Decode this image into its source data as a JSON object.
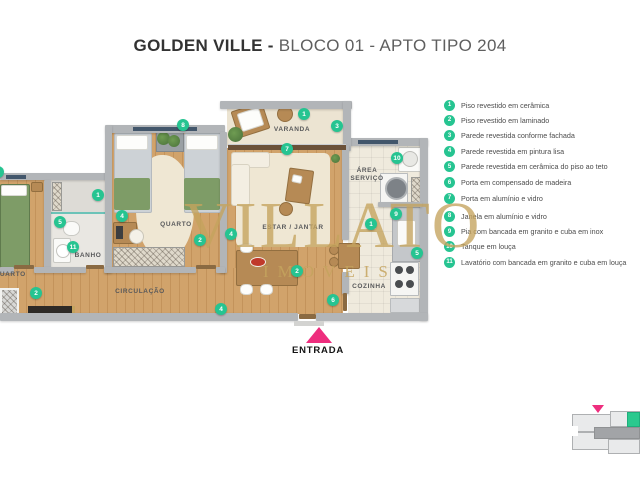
{
  "title": {
    "brand": "GOLDEN VILLE - ",
    "unit": "BLOCO 01 - APTO TIPO 204"
  },
  "watermark": {
    "name": "VILLATO",
    "tagline": "IMOVEIS"
  },
  "plan": {
    "rooms": {
      "varanda": {
        "label": "VARANDA"
      },
      "quarto_casal": {
        "label": "QUARTO"
      },
      "quarto_solteiro": {
        "label": "QUARTO"
      },
      "banho": {
        "label": "BANHO"
      },
      "estar_jantar": {
        "label": "ESTAR / JANTAR"
      },
      "area_servico": {
        "label": "ÁREA SERVIÇO"
      },
      "cozinha": {
        "label": "COZINHA"
      },
      "circulacao": {
        "label": "CIRCULAÇÃO"
      }
    },
    "entrance_label": "ENTRADA",
    "markers": [
      {
        "n": "8",
        "x": 183,
        "y": 125
      },
      {
        "n": "1",
        "x": 304,
        "y": 114
      },
      {
        "n": "3",
        "x": 337,
        "y": 126
      },
      {
        "n": "7",
        "x": 287,
        "y": 149
      },
      {
        "n": "10",
        "x": 397,
        "y": 158
      },
      {
        "n": "3",
        "x": -2,
        "y": 172
      },
      {
        "n": "1",
        "x": 98,
        "y": 195
      },
      {
        "n": "9",
        "x": 396,
        "y": 214
      },
      {
        "n": "4",
        "x": 122,
        "y": 216
      },
      {
        "n": "5",
        "x": 60,
        "y": 222
      },
      {
        "n": "1",
        "x": 371,
        "y": 224
      },
      {
        "n": "4",
        "x": 231,
        "y": 234
      },
      {
        "n": "2",
        "x": 200,
        "y": 240
      },
      {
        "n": "11",
        "x": 73,
        "y": 247
      },
      {
        "n": "5",
        "x": 417,
        "y": 253
      },
      {
        "n": "2",
        "x": 297,
        "y": 271
      },
      {
        "n": "2",
        "x": 36,
        "y": 293
      },
      {
        "n": "6",
        "x": 333,
        "y": 300
      },
      {
        "n": "4",
        "x": 221,
        "y": 309
      }
    ]
  },
  "legend": {
    "items": [
      {
        "n": "1",
        "text": "Piso revestido em cerâmica"
      },
      {
        "n": "2",
        "text": "Piso revestido em laminado"
      },
      {
        "n": "3",
        "text": "Parede revestida conforme fachada"
      },
      {
        "n": "4",
        "text": "Parede revestida em pintura lisa"
      },
      {
        "n": "5",
        "text": "Parede revestida em cerâmica do piso ao teto"
      },
      {
        "n": "6",
        "text": "Porta em compensado de madeira"
      },
      {
        "n": "7",
        "text": "Porta em alumínio e vidro"
      },
      {
        "n": "8",
        "text": "Janela em alumínio e vidro"
      },
      {
        "n": "9",
        "text": "Pia com bancada em granito e cuba em inox"
      },
      {
        "n": "10",
        "text": "Tanque em louça"
      },
      {
        "n": "11",
        "text": "Lavatório com bancada em granito e cuba em louça"
      }
    ]
  },
  "colors": {
    "marker_teal": "#26c491",
    "entry_pink": "#ee2e7e",
    "watermark_gold": "#c5a45e",
    "minimap_unit_green": "#2bc98e"
  }
}
